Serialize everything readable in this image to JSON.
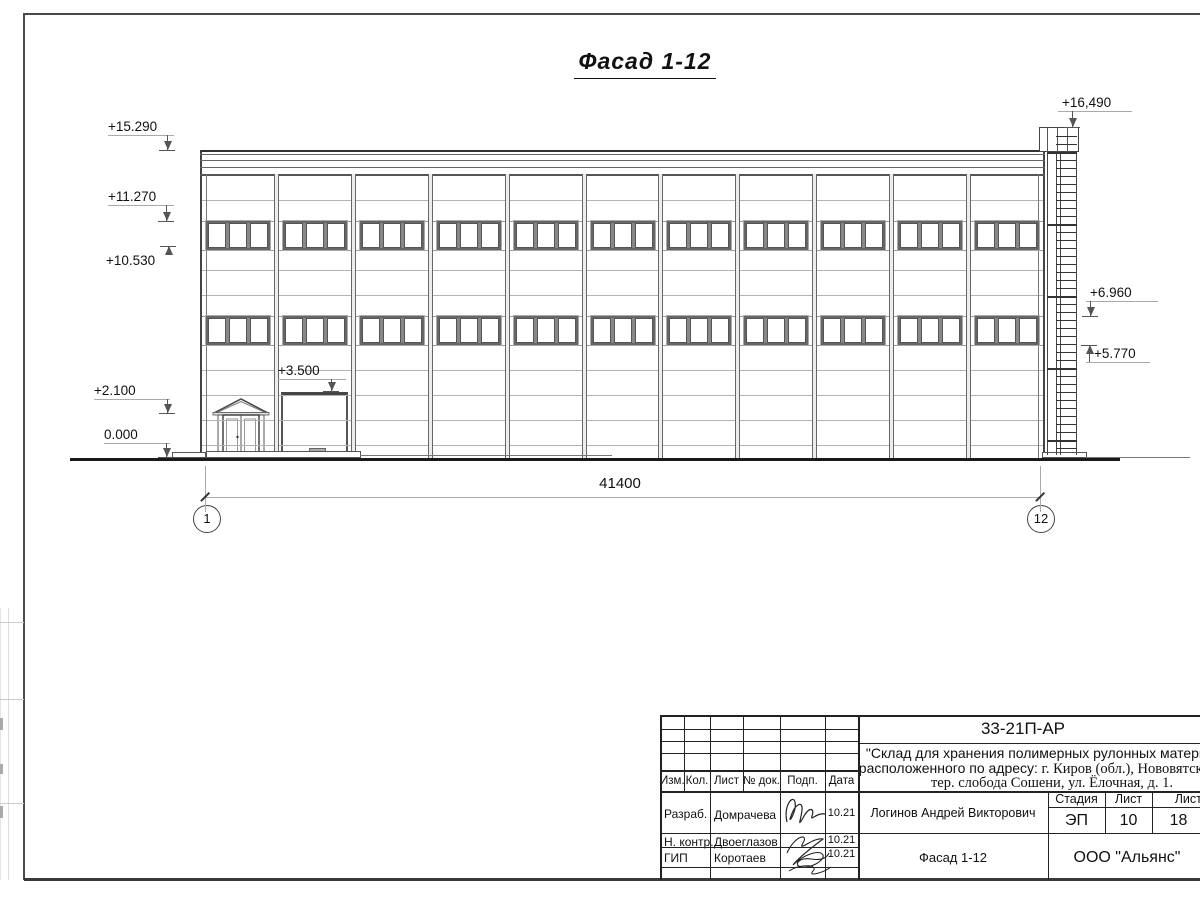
{
  "drawing": {
    "view_title": "Фасад 1-12",
    "length_dimension": "41400",
    "grid_axes": [
      "1",
      "12"
    ],
    "elevation_marks": [
      "+15.290",
      "+11.270",
      "+10.530",
      "+2.100",
      "0.000",
      "+3.500",
      "+16,490",
      "+6.960",
      "+5.770"
    ],
    "facade": {
      "bays": 11,
      "window_rows": 2,
      "panes_per_window": 3,
      "has_entrance_door": true,
      "has_gate": true,
      "has_fire_ladder": true
    }
  },
  "title_block": {
    "doc_code": "33-21П-АР",
    "project_name_line1": "\"Склад для хранения полимерных рулонных материалов",
    "project_addr_prefix": "расположенного по адресу:",
    "project_addr_rest": " г. Киров (обл.), Нововятский р-н,",
    "project_addr_line3": "тер. слобода Сошени, ул. Ёлочная, д. 1.",
    "columns": [
      "Изм.",
      "Кол.",
      "Лист",
      "№ док.",
      "Подп.",
      "Дата"
    ],
    "roles": [
      {
        "role": "Разраб.",
        "name": "Домрачева",
        "date": "10.21"
      },
      {
        "role": "Н. контр.",
        "name": "Двоеглазов",
        "date": "10.21"
      },
      {
        "role": "ГИП",
        "name": "Коротаев",
        "date": "10.21"
      }
    ],
    "chief": "Логинов Андрей Викторович",
    "stage_label": "Стадия",
    "sheet_label": "Лист",
    "sheets_label": "Листов",
    "stage": "ЭП",
    "sheet": "10",
    "sheets": "18",
    "sheet_name": "Фасад 1-12",
    "company": "ООО \"Альянс\""
  }
}
